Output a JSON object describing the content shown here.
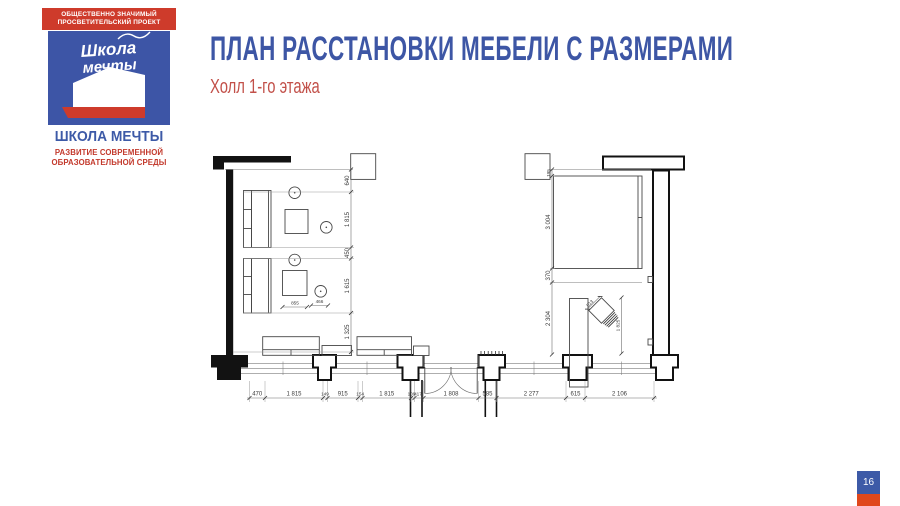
{
  "slide": {
    "title": "ПЛАН РАССТАНОВКИ МЕБЕЛИ С РАЗМЕРАМИ",
    "subtitle": "Холл 1-го этажа",
    "page_number": "16",
    "colors": {
      "blue": "#3d56a5",
      "red": "#ce3b2b",
      "badge_red": "#e0481c",
      "subtitle_red": "#c25049"
    }
  },
  "logo": {
    "header_line1": "ОБЩЕСТВЕННО ЗНАЧИМЫЙ",
    "header_line2": "ПРОСВЕТИТЕЛЬСКИЙ ПРОЕКТ",
    "script_line1": "Школа",
    "script_line2": "мечты",
    "name": "ШКОЛА МЕЧТЫ",
    "tagline_line1": "РАЗВИТИЕ СОВРЕМЕННОЙ",
    "tagline_line2": "ОБРАЗОВАТЕЛЬНОЙ СРЕДЫ"
  },
  "plan": {
    "left_chain": [
      "640",
      "1 815",
      "450",
      "1 615",
      "1 325"
    ],
    "right_chain": [
      "195",
      "3 004",
      "370",
      "2 304"
    ],
    "bottom_chain": [
      "470",
      "1 815",
      "149",
      "915",
      "154",
      "1 815",
      "109",
      "417",
      "1 808",
      "585",
      "2 277",
      "615",
      "2 106"
    ],
    "table_dims": [
      "855",
      "466"
    ],
    "chair_dims": [
      "513",
      "1 825"
    ]
  }
}
